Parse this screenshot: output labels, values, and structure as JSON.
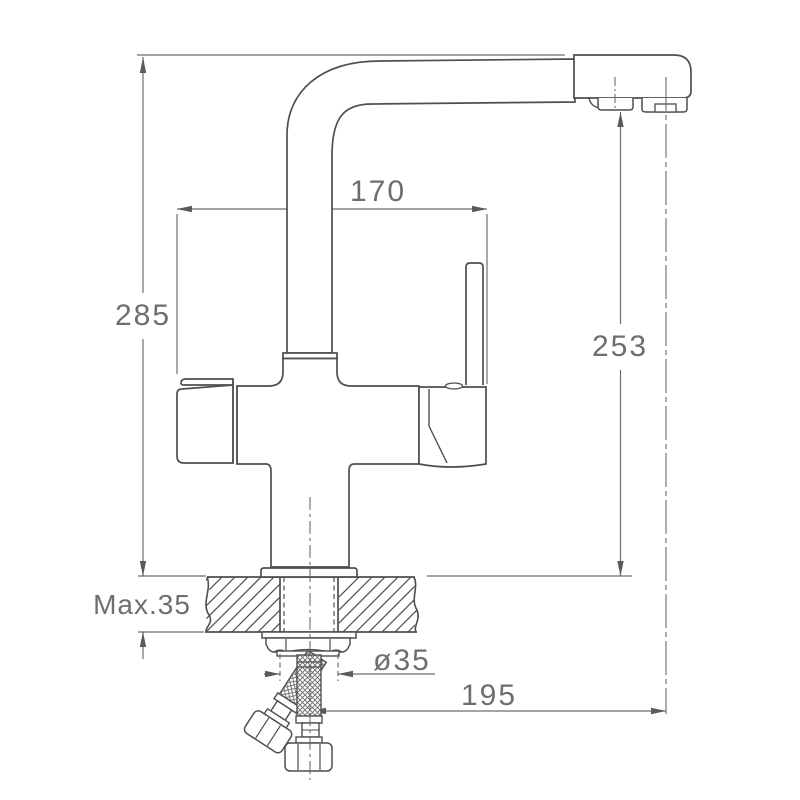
{
  "drawing": {
    "kind": "technical installation drawing",
    "subject": "two-channel kitchen mixer faucet with filtered water outlet, side view with counter cross-section and flexible supply hoses"
  },
  "labels": {
    "spout_reach": "170",
    "total_height": "285",
    "spout_height": "253",
    "counter_thickness": "Max.35",
    "hole_diameter": "ø35",
    "outlet_offset": "195"
  },
  "colors": {
    "line": "#4f4f4f",
    "dimension": "#6e6e6e",
    "arrow": "#5a5a5a",
    "text": "#6e6e6e",
    "background": "#ffffff"
  }
}
